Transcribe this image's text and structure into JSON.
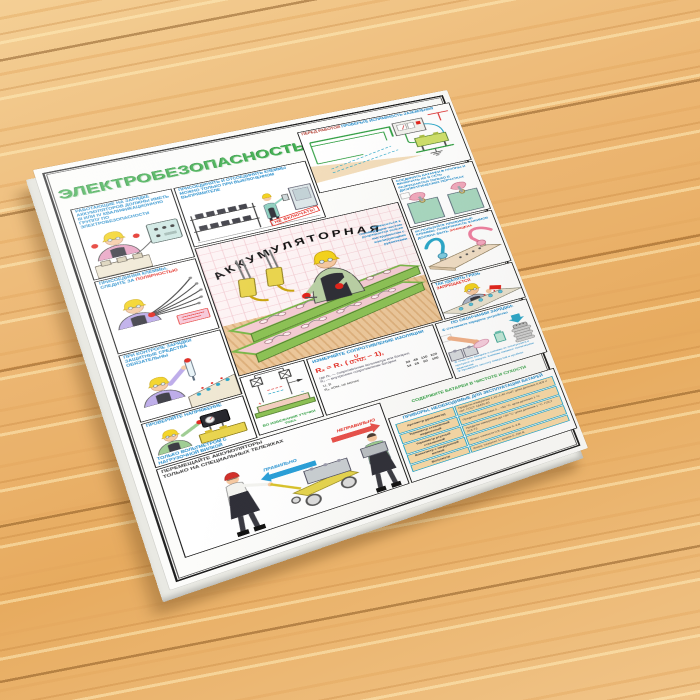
{
  "poster": {
    "title": "ЭЛЕКТРОБЕЗОПАСНОСТЬ",
    "center": {
      "arc_title": "АККУМУЛЯТОРНАЯ",
      "note": "Прикасаться к токоведущим частям разрешается только инструментом с изолирующими рукоятками"
    },
    "panels": {
      "qualification": {
        "caption": "РАБОТАЮЩИЕ НА ЗАРЯДКЕ АККУМУЛЯТОРОВ ДОЛЖНЫ ИМЕТЬ III ИЛИ IV КВАЛИФИКАЦИОННУЮ ГРУППУ ПО ЭЛЕКТРОБЕЗОПАСНОСТИ"
      },
      "polarity": {
        "caption_1": "ПРИСОЕДИНЯЯ КЛЕММЫ, СЛЕДИТЕ ЗА ",
        "caption_2": "ПОЛЯРНОСТЬЮ"
      },
      "charge_control": {
        "caption": "ПРИ КОНТРОЛЕ ЗАРЯДКИ ЗАЩИТНЫЕ СРЕДСТВА ОБЯЗАТЕЛЬНЫ"
      },
      "voltage": {
        "caption_1": "ПРОВЕРЯЙТЕ НАПРЯЖЕНИЕ",
        "caption_2": "ТОЛЬКО ВОЛЬТМЕТРОМ С НАГРУЗОЧНОЙ ВИЛКОЙ"
      },
      "disconnect": {
        "caption": "ПРИСОЕДИНЯТЬ И ОТСОЕДИНЯТЬ КЛЕММЫ МОЖНО ТОЛЬКО ПРИ ВЫКЛЮЧЕННОМ ВЫПРЯМИТЕЛЕ",
        "tag": "НЕ ВКЛЮЧАТЬ!"
      },
      "grounding": {
        "caption_red": "ПЕРЕД РАБОТОЙ ",
        "caption_teal": "ПРОВЕРЬТЕ ИСПРАВНОСТЬ ЗАЗЕМЛЕНИЯ"
      },
      "gloves": {
        "caption": "СОЕДИНЯТЬ БАТАРЕИ В ГРУППЫ И ВКЛЮЧАТЬ ИХ В СЕТЬ РАЗРЕШАЕТСЯ ТОЛЬКО В ДИЭЛЕКТРИЧЕСКИХ ПЕРЧАТКАХ"
      },
      "clamps": {
        "caption_1": "ИСПОЛЬЗУЙТЕ ПРИЖИМНЫЕ КЛЕММЫ. ПОВЕРХНОСТЬ ЗАЖИМОВ ДОЛЖНА БЫТЬ ",
        "caption_2": "ЗАЧИЩЕНА"
      },
      "dirt": {
        "caption_1": "ТАК УДАЛЯТЬ ГРЯЗЬ ",
        "caption_2": "ЗАПРЕЩАЕТСЯ"
      },
      "insulation": {
        "title": "ИЗМЕРЯЙТЕ СОПРОТИВЛЕНИЕ ИЗОЛЯЦИИ",
        "formula_pre": "Rₓ = R₁ (",
        "formula_num": "U",
        "formula_den": "U₁+U₂",
        "formula_post": "− 1),",
        "note_1": "где R₁ — сопротивление вольтметра или батареи;",
        "note_2": "R₂ — внутреннее сопротивление батареи",
        "row_u_label": "U, В",
        "row_u_values": "24   48   110   220",
        "row_r_label": "Rₓ, кОм, не менее",
        "row_r_values": "14   25    50    100"
      },
      "leakage": {
        "caption_1": "ВО ИЗБЕЖАНИЕ УТЕЧКИ ТОКА ",
        "caption_2": "СОДЕРЖИТЕ БАТАРЕИ В ЧИСТОТЕ И СУХОСТИ"
      },
      "after_charge": {
        "title": "ПО ОКОНЧАНИИ ЗАРЯДКИ:",
        "step_1": "① Отключите зарядное устройство",
        "step_2": "② Очистите батареи и клеммы от электролита и протрите их насухо. Клеммы смажьте техническим вазелином",
        "step_3": "③ Проверьте чистоту отверстий в пробках"
      },
      "trolley": {
        "caption": "ПЕРЕМЕЩАЙТЕ АККУМУЛЯТОРЫ ТОЛЬКО НА СПЕЦИАЛЬНЫХ ТЕЛЕЖКАХ",
        "correct": "ПРАВИЛЬНО",
        "incorrect": "НЕПРАВИЛЬНО"
      },
      "instruments": {
        "title": "ПРИБОРЫ, НЕОБХОДИМЫЕ ДЛЯ ЭКСПЛУАТАЦИИ БАТАРЕЙ",
        "rows": [
          {
            "name": "Ареометр (денсиметр)",
            "spec": "Пределы измерения 1,10–1,40 г/см³; цена деления 0,005 г/см³. ГОСТ 18481-81"
          },
          {
            "name": "Термометр стеклянный жидкостный",
            "spec": "Пределы измерения 0…+50 °С; цена деления 1 °С"
          },
          {
            "name": "Термометр ртутный стеклянный",
            "spec": "Пределы измерения до +50 °С; цена деления 1 °С. ГОСТ 215-73"
          },
          {
            "name": "Вольтметр с нагрузочной вилкой",
            "spec": "Класс точности 0,5; шкала 0–3 В"
          },
          {
            "name": "Вольтметр",
            "spec": "Класс точности 1; шкала 0–150 В"
          }
        ]
      }
    },
    "colors": {
      "title_green": "#3fae4e",
      "caption_teal": "#1886c8",
      "warning_red": "#e2231a",
      "correct_blue": "#1f8fd0",
      "wood": "#ecb76f"
    }
  }
}
